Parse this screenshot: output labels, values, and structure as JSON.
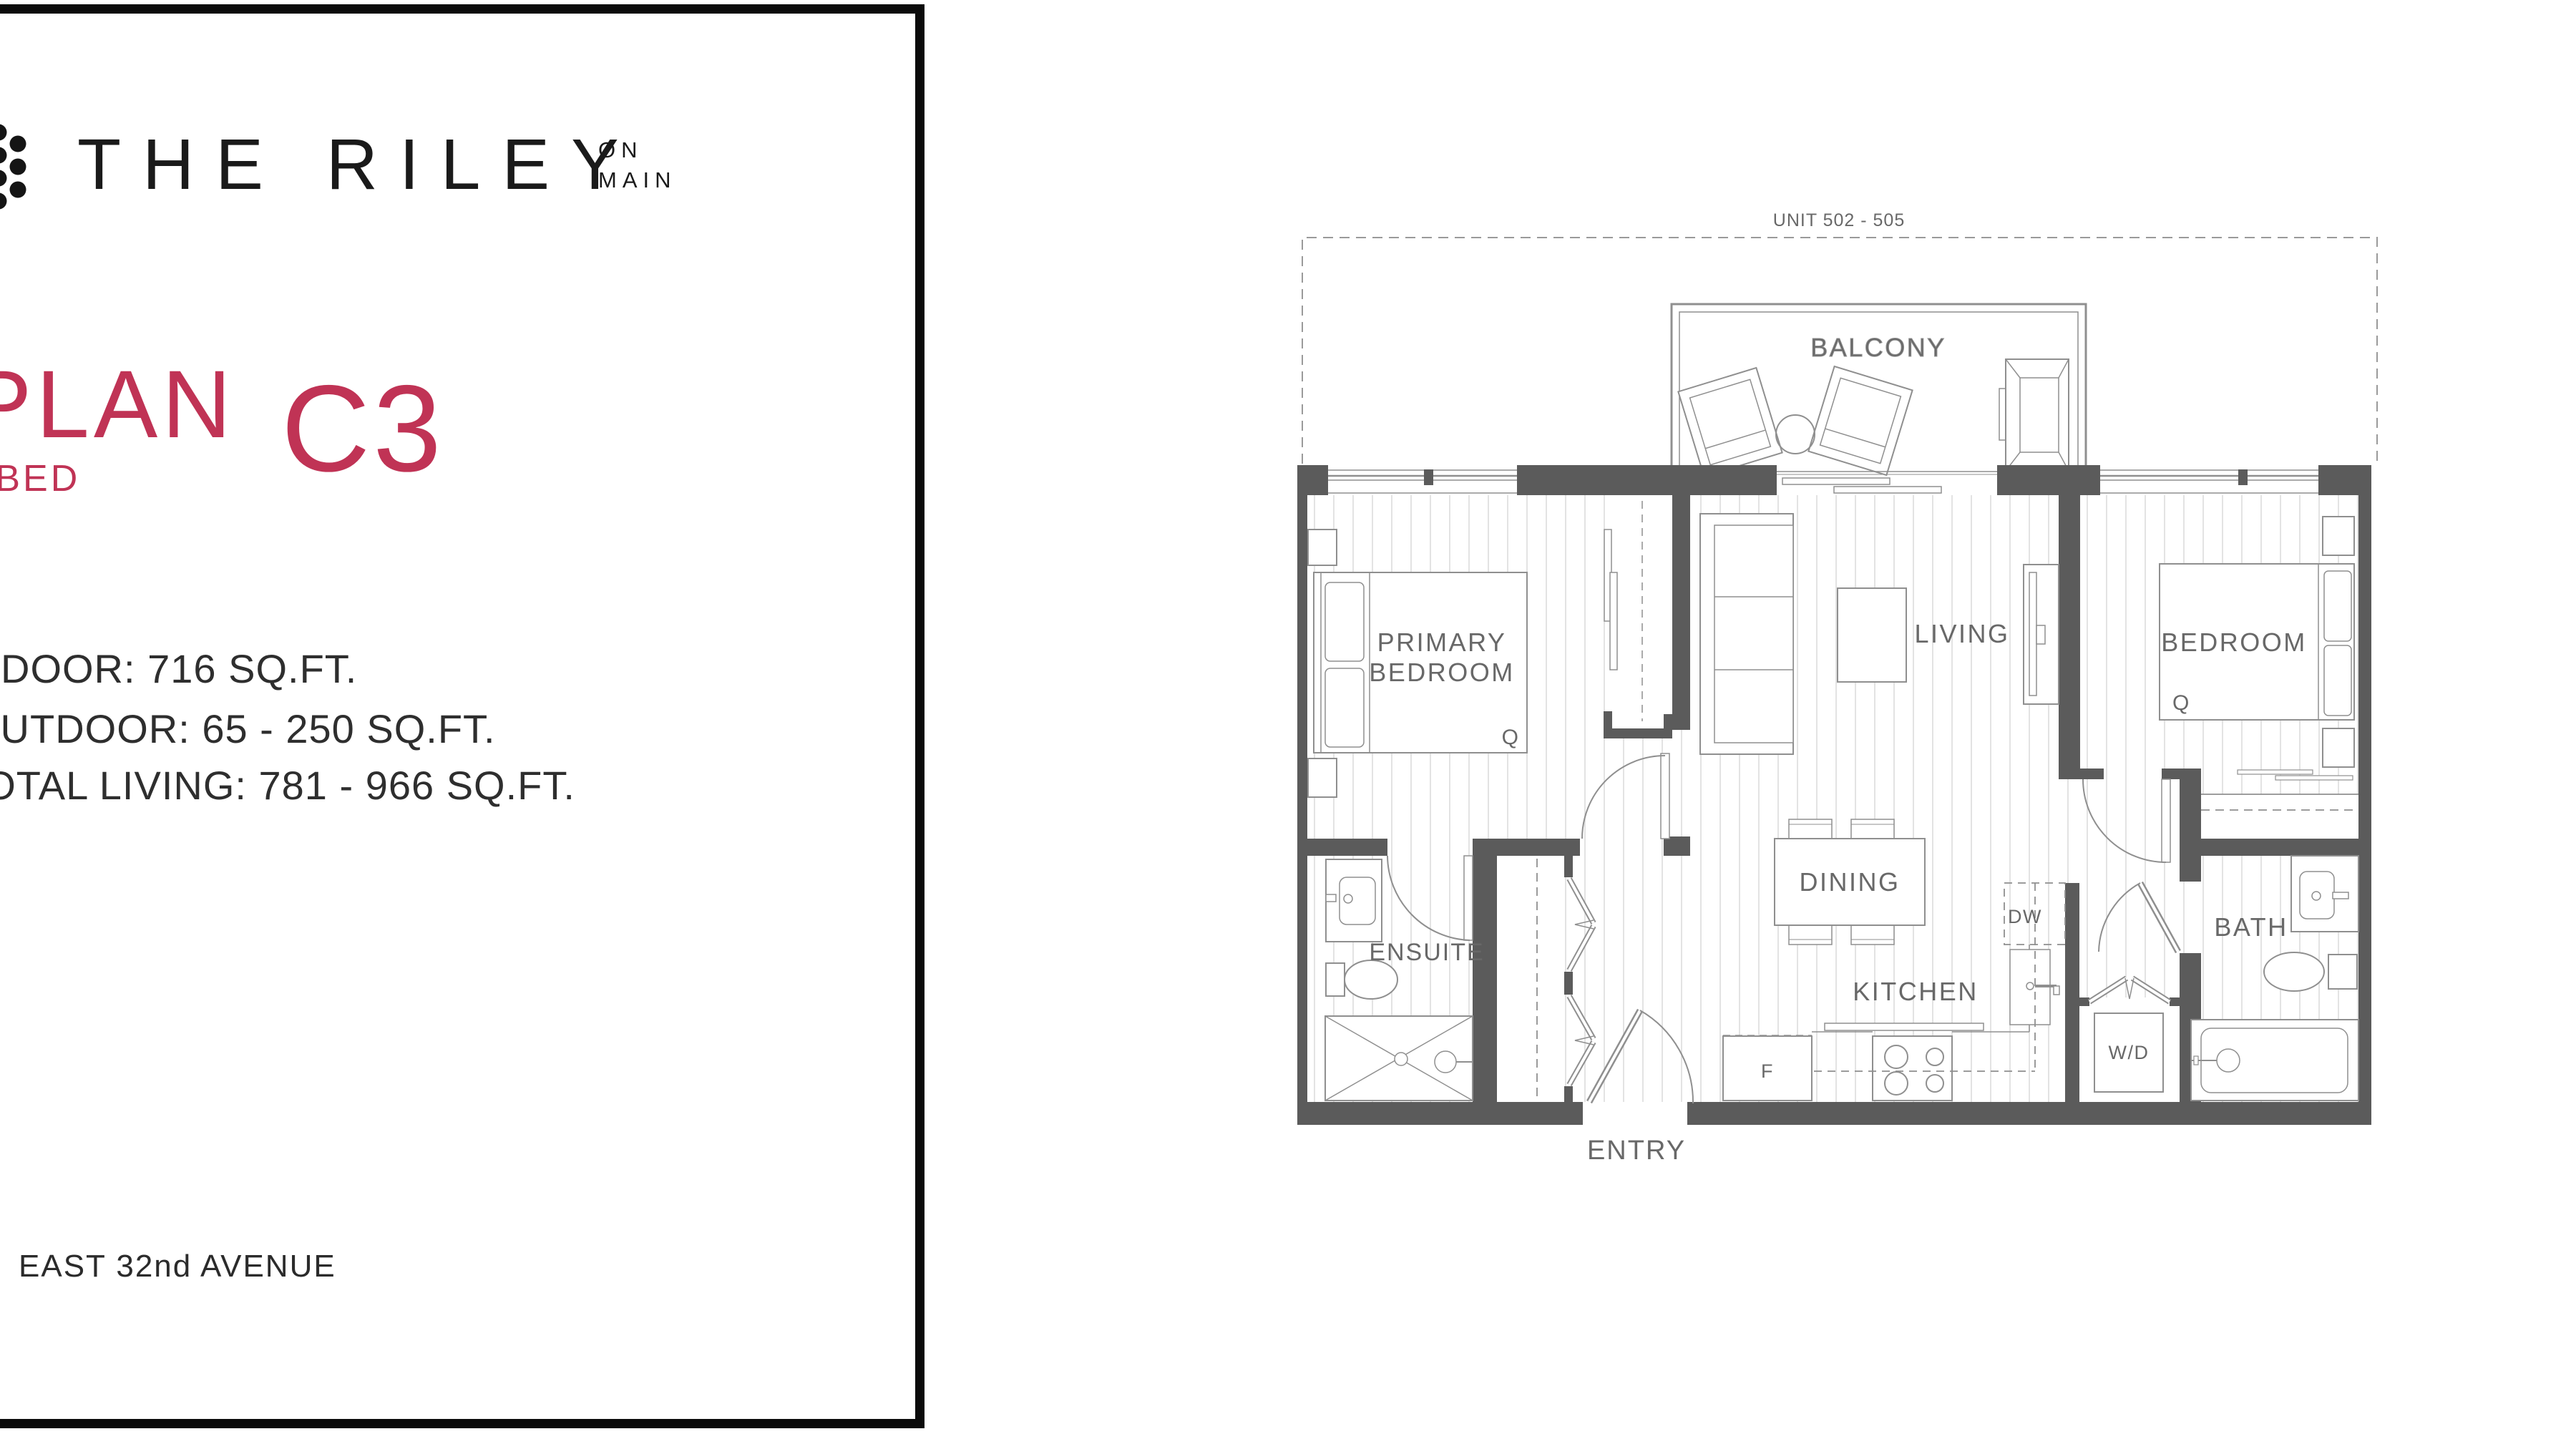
{
  "brand": {
    "title": "THE RILEY",
    "tag_line1": "ON",
    "tag_line2": "MAIN"
  },
  "plan": {
    "word": "PLAN",
    "code": "C3",
    "bedrooms": "2 BED"
  },
  "stats": {
    "indoor": "INDOOR: 716 SQ.FT.",
    "outdoor": "OUTDOOR: 65 - 250 SQ.FT.",
    "total": "TOTAL LIVING: 781 - 966 SQ.FT."
  },
  "address": "EAST 32nd AVENUE",
  "floorplan": {
    "unit": "UNIT 502 - 505",
    "balcony": "BALCONY",
    "primary_line1": "PRIMARY",
    "primary_line2": "BEDROOM",
    "living": "LIVING",
    "bedroom": "BEDROOM",
    "dining": "DINING",
    "kitchen": "KITCHEN",
    "ensuite": "ENSUITE",
    "bath": "BATH",
    "entry": "ENTRY",
    "washer_dryer": "W/D",
    "dishwasher": "DW",
    "fridge": "F",
    "queen": "Q"
  },
  "colors": {
    "accent": "#C03355",
    "wall": "#5B5B5B",
    "line": "#8F8F8F",
    "label": "#686868",
    "hatch": "#DCDCDC",
    "panel_border": "#0B0B0B"
  }
}
